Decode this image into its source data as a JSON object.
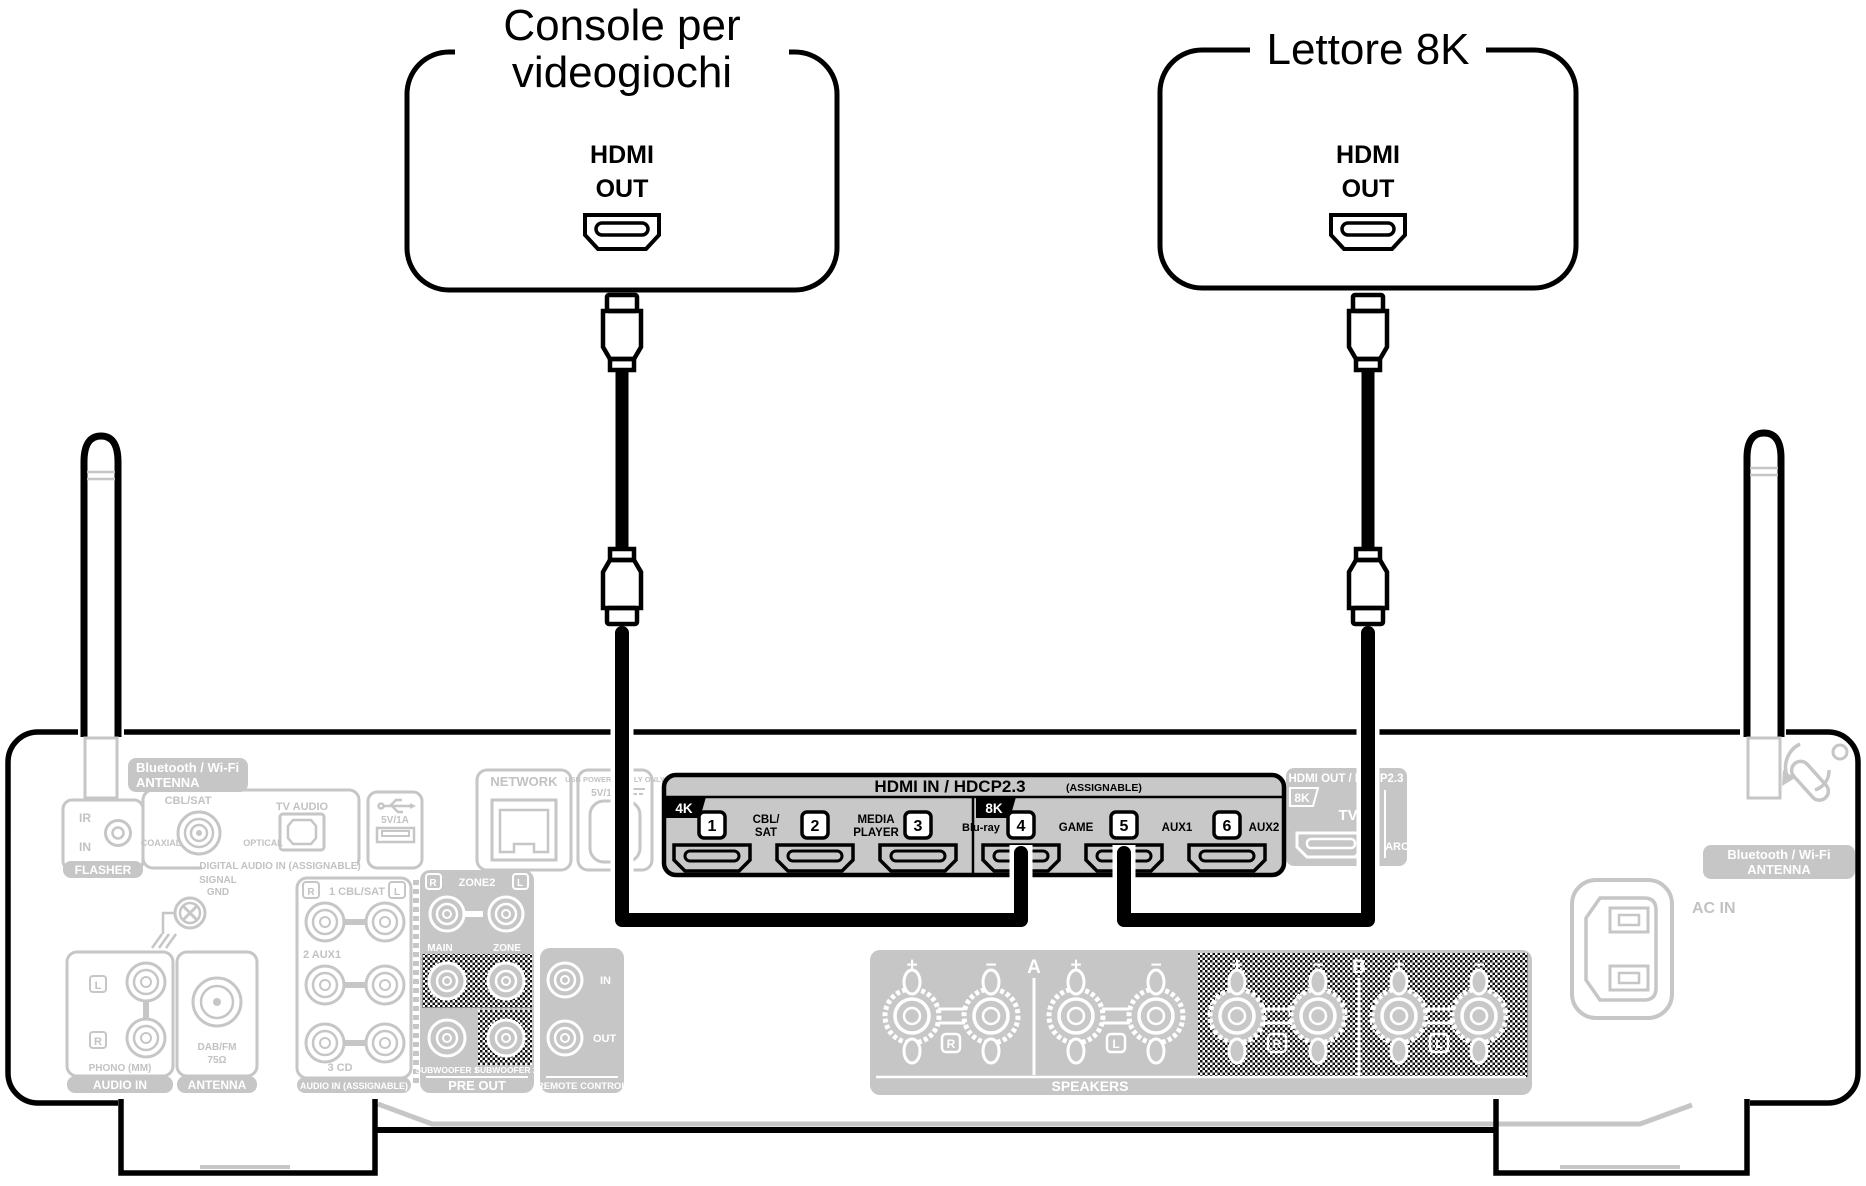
{
  "devices": {
    "console": {
      "title_line1": "Console per",
      "title_line2": "videogiochi",
      "port_line1": "HDMI",
      "port_line2": "OUT"
    },
    "player8k": {
      "title": "Lettore 8K",
      "port_line1": "HDMI",
      "port_line2": "OUT"
    }
  },
  "receiver": {
    "bt_antenna_left": {
      "line1": "Bluetooth / Wi-Fi",
      "line2": "ANTENNA"
    },
    "bt_antenna_right": {
      "line1": "Bluetooth / Wi-Fi",
      "line2": "ANTENNA"
    },
    "flasher": {
      "ir": "IR",
      "in_label": "IN",
      "tab": "FLASHER"
    },
    "digital_audio_in": {
      "cbl_sat": "CBL/SAT",
      "coaxial": "COAXIAL",
      "tv_audio": "TV AUDIO",
      "optical": "OPTICAL",
      "tab": "DIGITAL AUDIO IN (ASSIGNABLE)"
    },
    "usb": {
      "rating": "5V/1A"
    },
    "network": {
      "label": "NETWORK"
    },
    "usb_power": {
      "line1": "USB POWER SUPPLY ONLY",
      "line2": "5V/1A"
    },
    "signal_gnd": {
      "line1": "SIGNAL",
      "line2": "GND"
    },
    "phono": {
      "l": "L",
      "r": "R",
      "label": "PHONO (MM)",
      "tab": "AUDIO IN"
    },
    "tuner_antenna": {
      "line1": "DAB/FM",
      "line2": "75Ω",
      "tab": "ANTENNA"
    },
    "audio_in_assignable": {
      "r": "R",
      "l": "L",
      "row1": "1 CBL/SAT",
      "row2": "2 AUX1",
      "row3": "3 CD",
      "tab": "AUDIO IN (ASSIGNABLE)"
    },
    "pre_out": {
      "r": "R",
      "zone2": "ZONE2",
      "l": "L",
      "main": "MAIN",
      "zone": "ZONE",
      "sub1": "SUBWOOFER 1",
      "sub2": "SUBWOOFER 2",
      "tab": "PRE OUT"
    },
    "remote_control": {
      "in_label": "IN",
      "out_label": "OUT",
      "tab": "REMOTE CONTROL"
    },
    "hdmi_in": {
      "header": "HDMI IN / HDCP2.3",
      "assignable": "(ASSIGNABLE)",
      "badge_left": "4K",
      "badge_right": "8K",
      "ports": [
        {
          "num": "1",
          "label_line1": "CBL/",
          "label_line2": "SAT"
        },
        {
          "num": "2",
          "label_line1": "MEDIA",
          "label_line2": "PLAYER"
        },
        {
          "num": "3",
          "label_line1": "Blu-ray",
          "label_line2": ""
        },
        {
          "num": "4",
          "label_line1": "GAME",
          "label_line2": ""
        },
        {
          "num": "5",
          "label_line1": "AUX1",
          "label_line2": ""
        },
        {
          "num": "6",
          "label_line1": "AUX2",
          "label_line2": ""
        }
      ]
    },
    "hdmi_out": {
      "header": "HDMI OUT / HDCP2.3",
      "badge": "8K",
      "tv": "TV",
      "arc": "ARC"
    },
    "speakers": {
      "plus": "+",
      "minus": "−",
      "group_a": "A",
      "group_b": "B",
      "r": "R",
      "l": "L",
      "tab": "SPEAKERS"
    },
    "ac_in": {
      "label": "AC IN"
    }
  },
  "colors": {
    "line_black": "#000000",
    "faded_gray": "#c6c6c6",
    "panel_gray": "#c8c8c8"
  }
}
